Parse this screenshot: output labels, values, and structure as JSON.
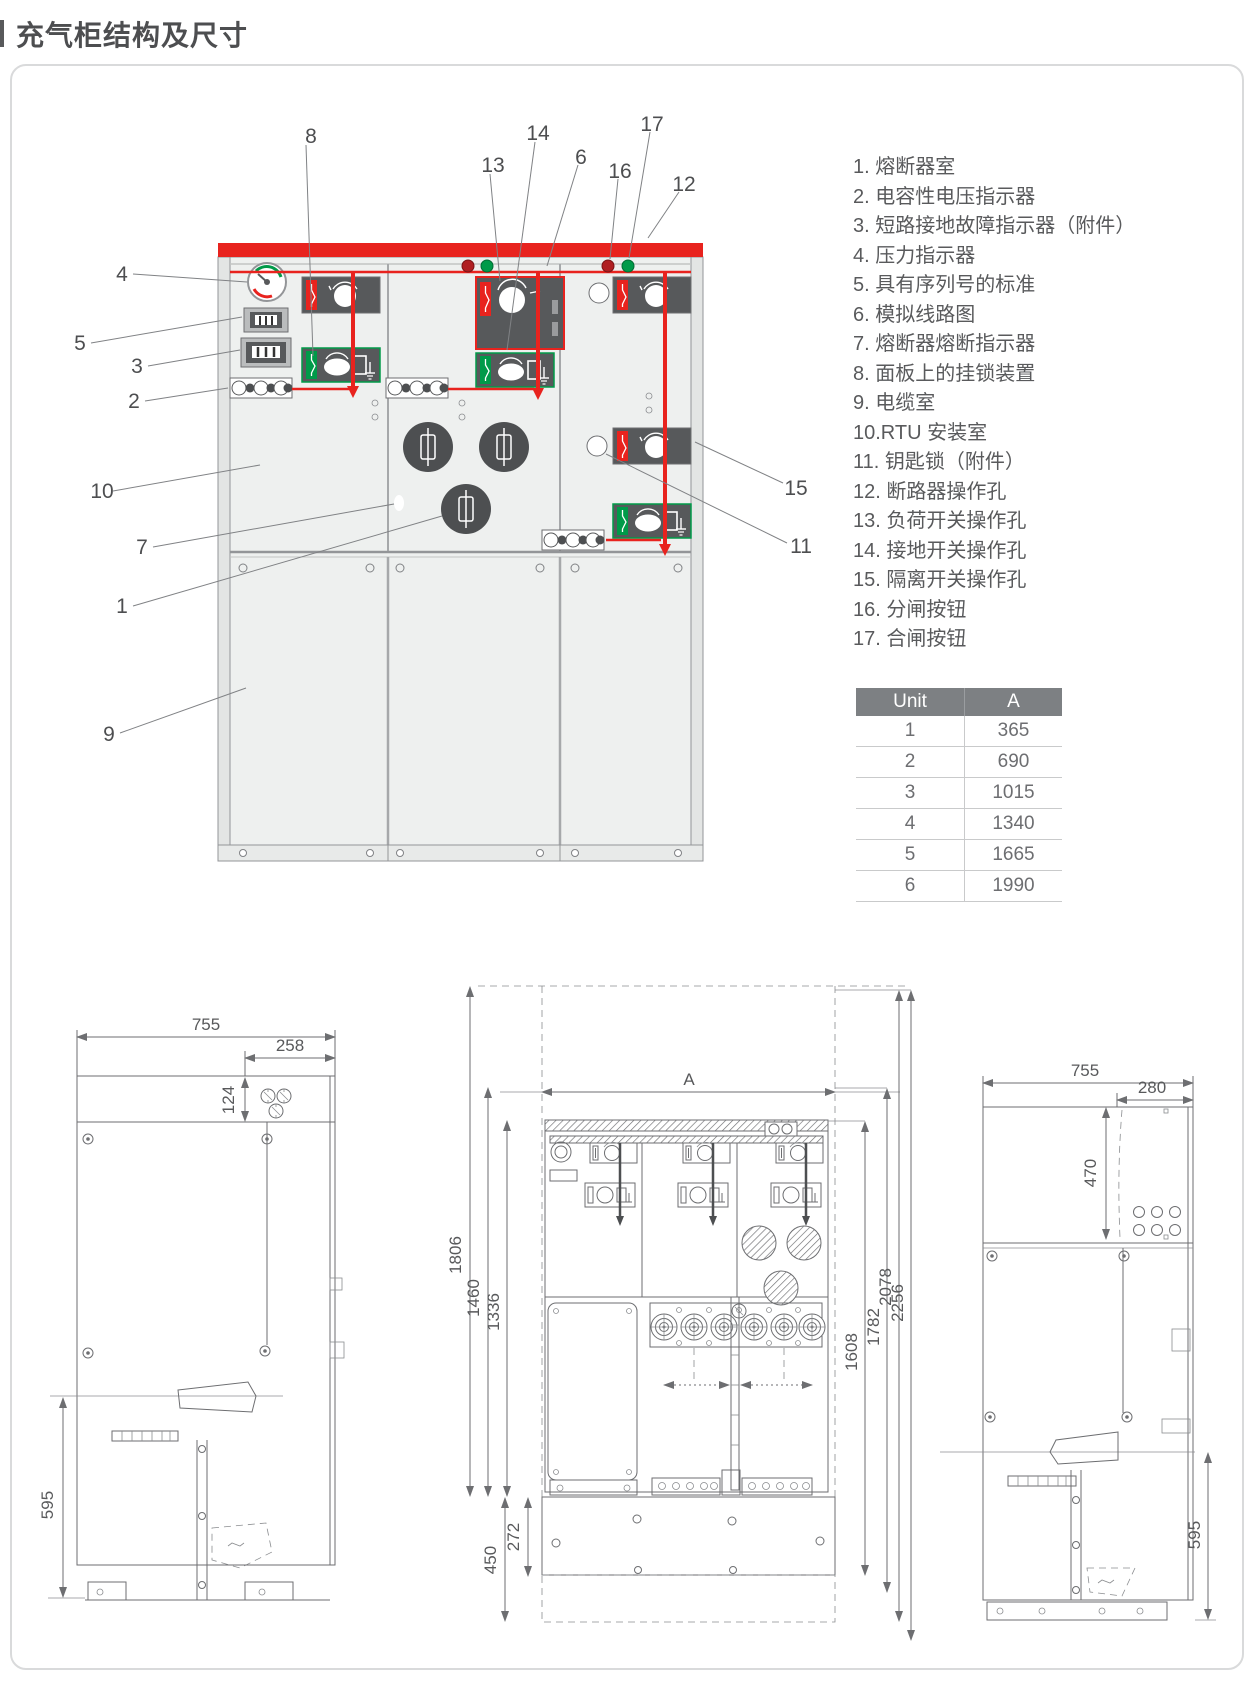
{
  "title": "充气柜结构及尺寸",
  "legend": {
    "items": [
      "1. 熔断器室",
      "2. 电容性电压指示器",
      "3. 短路接地故障指示器（附件）",
      "4. 压力指示器",
      "5. 具有序列号的标准",
      "6. 模拟线路图",
      "7. 熔断器熔断指示器",
      "8. 面板上的挂锁装置",
      "9. 电缆室",
      "10.RTU 安装室",
      "11. 钥匙锁（附件）",
      "12. 断路器操作孔",
      "13. 负荷开关操作孔",
      "14. 接地开关操作孔",
      "15. 隔离开关操作孔",
      "16. 分闸按钮",
      "17. 合闸按钮"
    ]
  },
  "table": {
    "headers": [
      "Unit",
      "A"
    ],
    "rows": [
      {
        "unit": "1",
        "a": "365"
      },
      {
        "unit": "2",
        "a": "690"
      },
      {
        "unit": "3",
        "a": "1015"
      },
      {
        "unit": "4",
        "a": "1340"
      },
      {
        "unit": "5",
        "a": "1665"
      },
      {
        "unit": "6",
        "a": "1990"
      }
    ]
  },
  "callouts": [
    "1",
    "2",
    "3",
    "4",
    "5",
    "6",
    "7",
    "8",
    "9",
    "10",
    "11",
    "12",
    "13",
    "14",
    "15",
    "16",
    "17"
  ],
  "dims": {
    "l755": "755",
    "l258": "258",
    "l124": "124",
    "l595": "595",
    "cA": "A",
    "c1806": "1806",
    "c1460": "1460",
    "c1336": "1336",
    "c1608": "1608",
    "c1782": "1782",
    "c2078": "2078",
    "c2256": "2256",
    "c450": "450",
    "c272": "272",
    "r755": "755",
    "r280": "280",
    "r470": "470",
    "r595": "595"
  },
  "colors": {
    "red": "#e8231e",
    "green": "#009a49",
    "module_gray": "#57595b",
    "cabinet_fill": "#eef0ef",
    "line_gray": "#6d6e71"
  }
}
